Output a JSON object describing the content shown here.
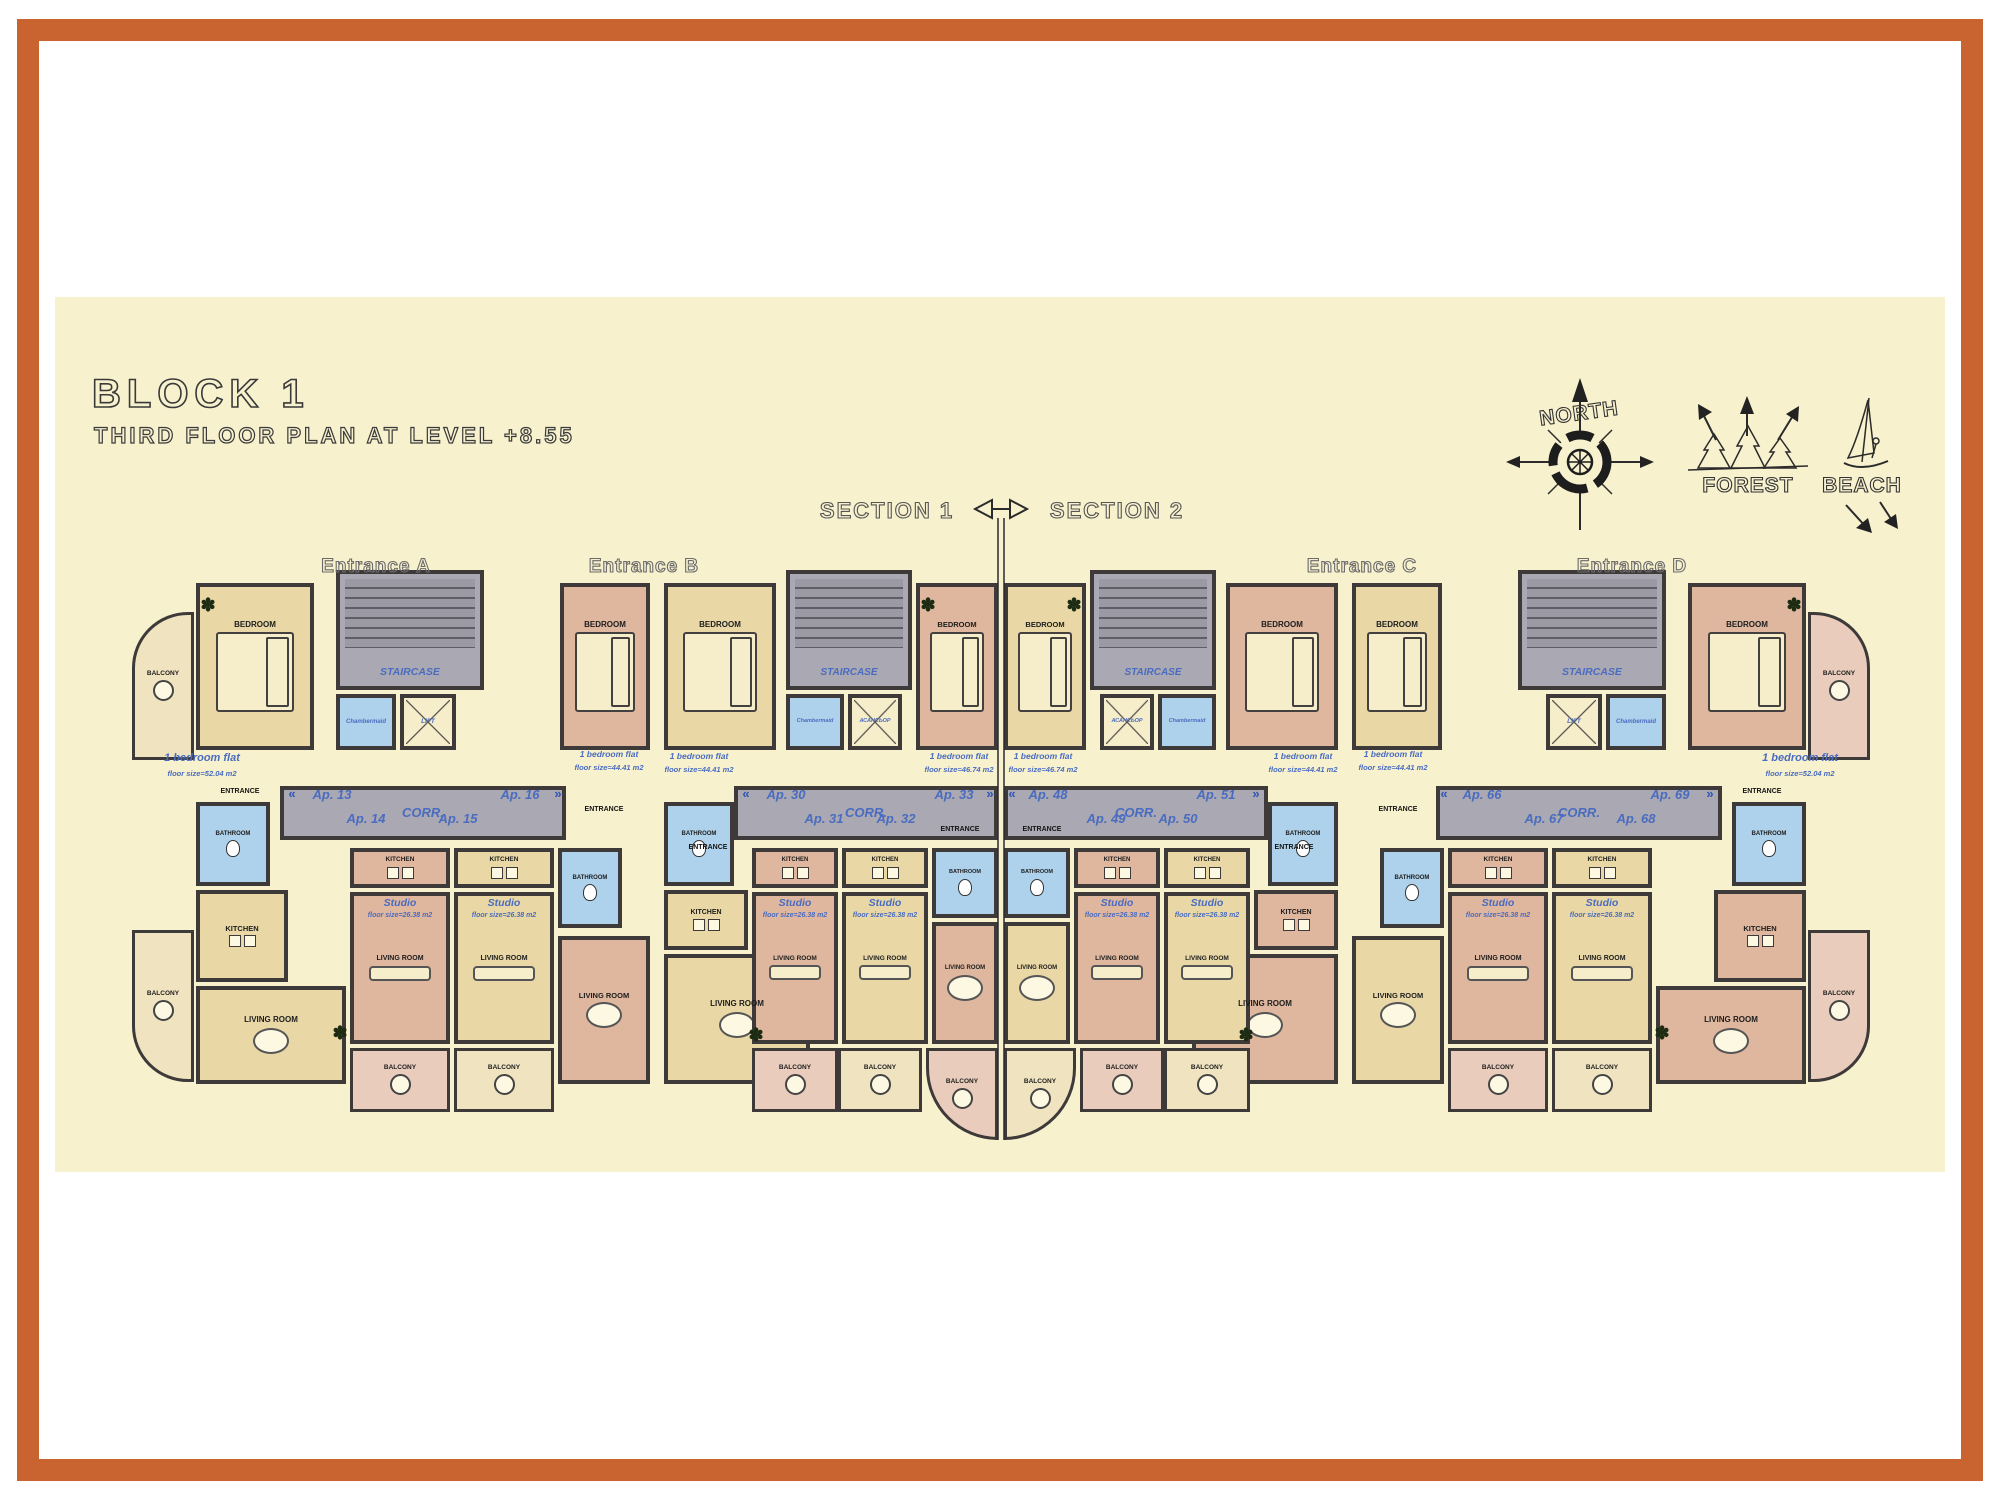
{
  "header": {
    "title": "BLOCK 1",
    "subtitle": "THIRD FLOOR PLAN AT LEVEL +8.55"
  },
  "legend": {
    "north": "NORTH",
    "forest": "FOREST",
    "beach": "BEACH"
  },
  "section": {
    "left": "SECTION 1",
    "right": "SECTION 2"
  },
  "labels": {
    "bedroom": "BEDROOM",
    "bathroom": "BATHROOM",
    "kitchen": "KITCHEN",
    "living_room": "LIVING ROOM",
    "balcony": "BALCONY",
    "entrance": "ENTRANCE",
    "corridor": "CORR.",
    "staircase": "STAIRCASE",
    "chambermaid": "Chambermaid",
    "lift": "LIFT",
    "lift_cyr": "АСАНСЬОР",
    "studio": "Studio",
    "one_bedroom_flat": "1 bedroom flat",
    "size_52": "floor size=52.04 m2",
    "size_44": "floor size=44.41 m2",
    "size_46": "floor size=46.74 m2",
    "size_26": "floor size=26.38 m2"
  },
  "units": [
    {
      "entrance": "Entrance A",
      "apartments": [
        "Ap. 13",
        "Ap. 14",
        "Ap. 15",
        "Ap. 16"
      ]
    },
    {
      "entrance": "Entrance B",
      "apartments": [
        "Ap. 30",
        "Ap. 31",
        "Ap. 32",
        "Ap. 33"
      ]
    },
    {
      "entrance": "Entrance C",
      "apartments": [
        "Ap. 48",
        "Ap. 49",
        "Ap. 50",
        "Ap. 51"
      ]
    },
    {
      "entrance": "Entrance D",
      "apartments": [
        "Ap. 66",
        "Ap. 67",
        "Ap. 68",
        "Ap. 69"
      ]
    }
  ],
  "icons": {
    "plant": "✽",
    "chevron_left": "«",
    "chevron_right": "»"
  },
  "colors": {
    "frame_orange": "#c9632f",
    "panel_cream": "#f7f1ce",
    "wall": "#3e3a39",
    "corridor_gray": "#aaa8b2",
    "flat_tan": "#e9d8a6",
    "flat_salmon": "#dfb69e",
    "bathroom_blue": "#aed2ec",
    "label_blue": "#4a6cc0"
  }
}
